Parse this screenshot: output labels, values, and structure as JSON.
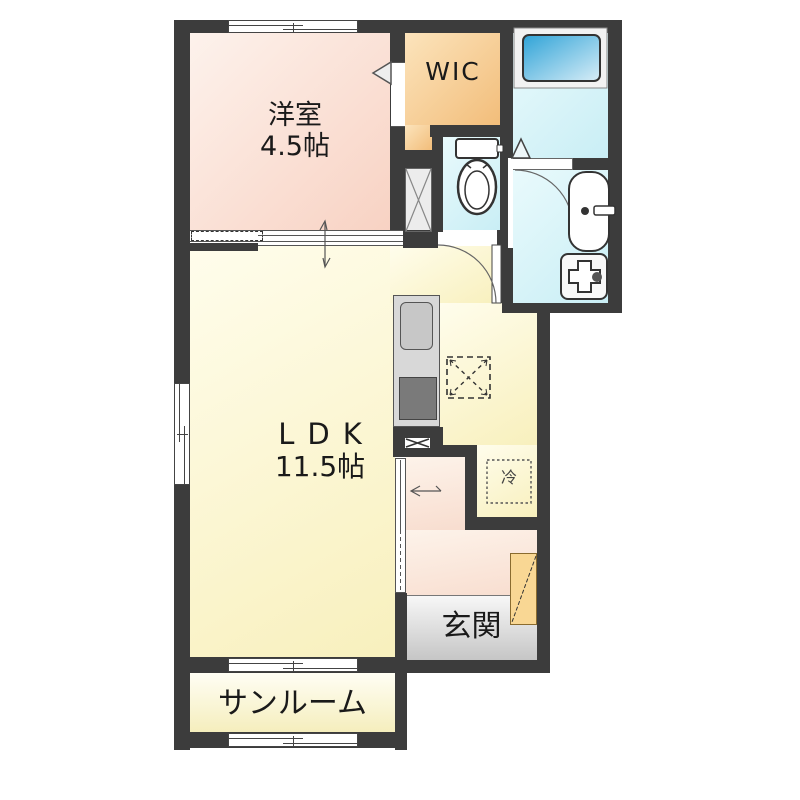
{
  "plan_title": "1LDK apartment floor plan",
  "rooms": {
    "yoshitsu": {
      "label": "洋室",
      "size": "4.5帖"
    },
    "wic": {
      "label": "WIC"
    },
    "ldk": {
      "label": "LDK",
      "size": "11.5帖"
    },
    "genkan": {
      "label": "玄関"
    },
    "sunroom": {
      "label": "サンルーム"
    },
    "refrigerator": {
      "label": "冷"
    }
  },
  "fixtures": {
    "bathtub": "bathtub",
    "toilet": "toilet",
    "washbasin": "washbasin",
    "washer_pan": "washing-machine-pan",
    "kitchen": "kitchen-counter-with-sink-and-stove",
    "pipe_space": "pipe-space-x-box",
    "fridge_space": "refrigerator-space"
  },
  "colors": {
    "wall": "#3c3c3c",
    "yoshitsu": "#f8d2c3",
    "wic": "#f2bd7a",
    "wet_rooms": "#c9eef5",
    "bathtub": "#2fa3d7",
    "ldk": "#f8f0bd",
    "hall": "#f8ddcf",
    "genkan": "#c5c5c5",
    "sunroom": "#f5eebd",
    "shoe_cabinet": "#f9d794"
  }
}
